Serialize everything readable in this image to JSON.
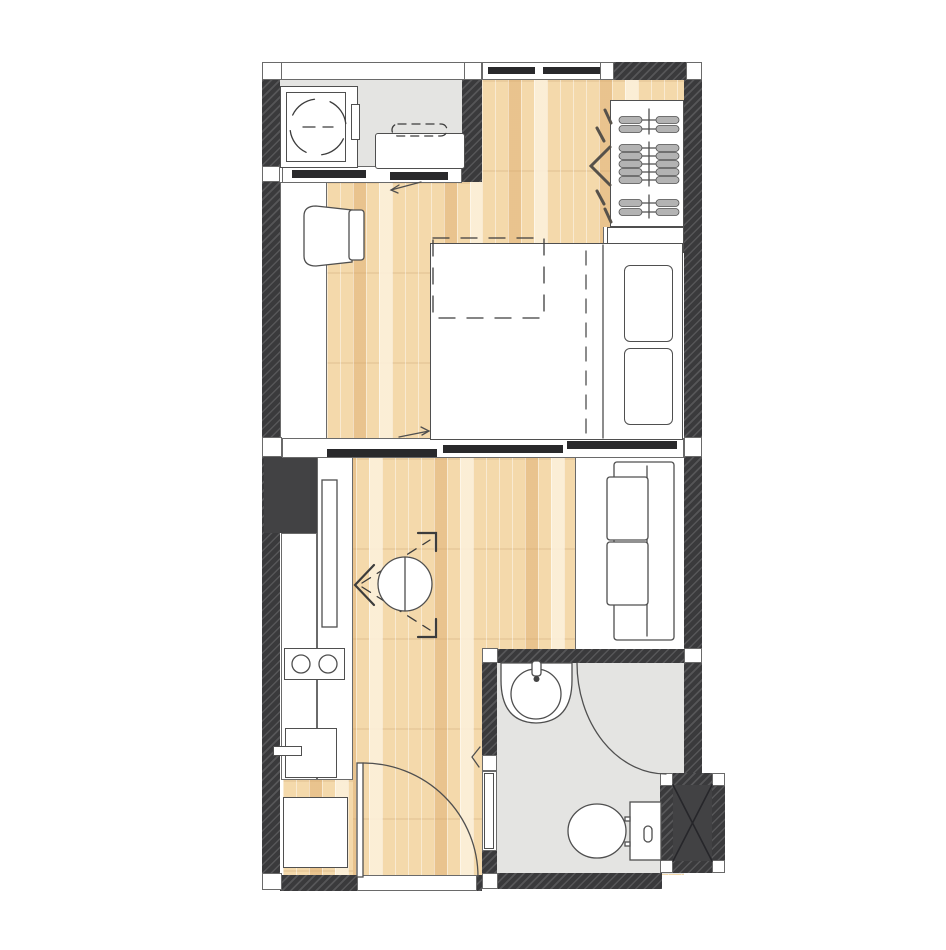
{
  "title": "studio-apartment-floor-plan",
  "colors": {
    "wall": "#3a3a3c",
    "bar": "#29292b",
    "line": "#4f4f4f",
    "frame-line": "#6a6a6a",
    "wood-base": "#f4d9ab",
    "floor-gray": "#e4e4e2",
    "white": "#ffffff",
    "hanger": "#b3b3b3",
    "dash-dark": "#3c3c3c",
    "bifold": "#56514a",
    "shaft-fill": "#424244"
  },
  "fixtures": [
    "washing-machine",
    "laundry-counter",
    "sliding-balcony-door",
    "wardrobe-with-hangers",
    "folding-wardrobe-door",
    "desk",
    "desk-chair",
    "double-bed",
    "pillows",
    "duvet-fold",
    "sliding-room-partition",
    "kitchen-counter",
    "cooktop-two-burners",
    "base-cabinet",
    "refrigerator",
    "round-folding-table",
    "sofa",
    "entrance-door",
    "washbasin",
    "corner-shower-screen",
    "toilet",
    "service-shaft"
  ]
}
